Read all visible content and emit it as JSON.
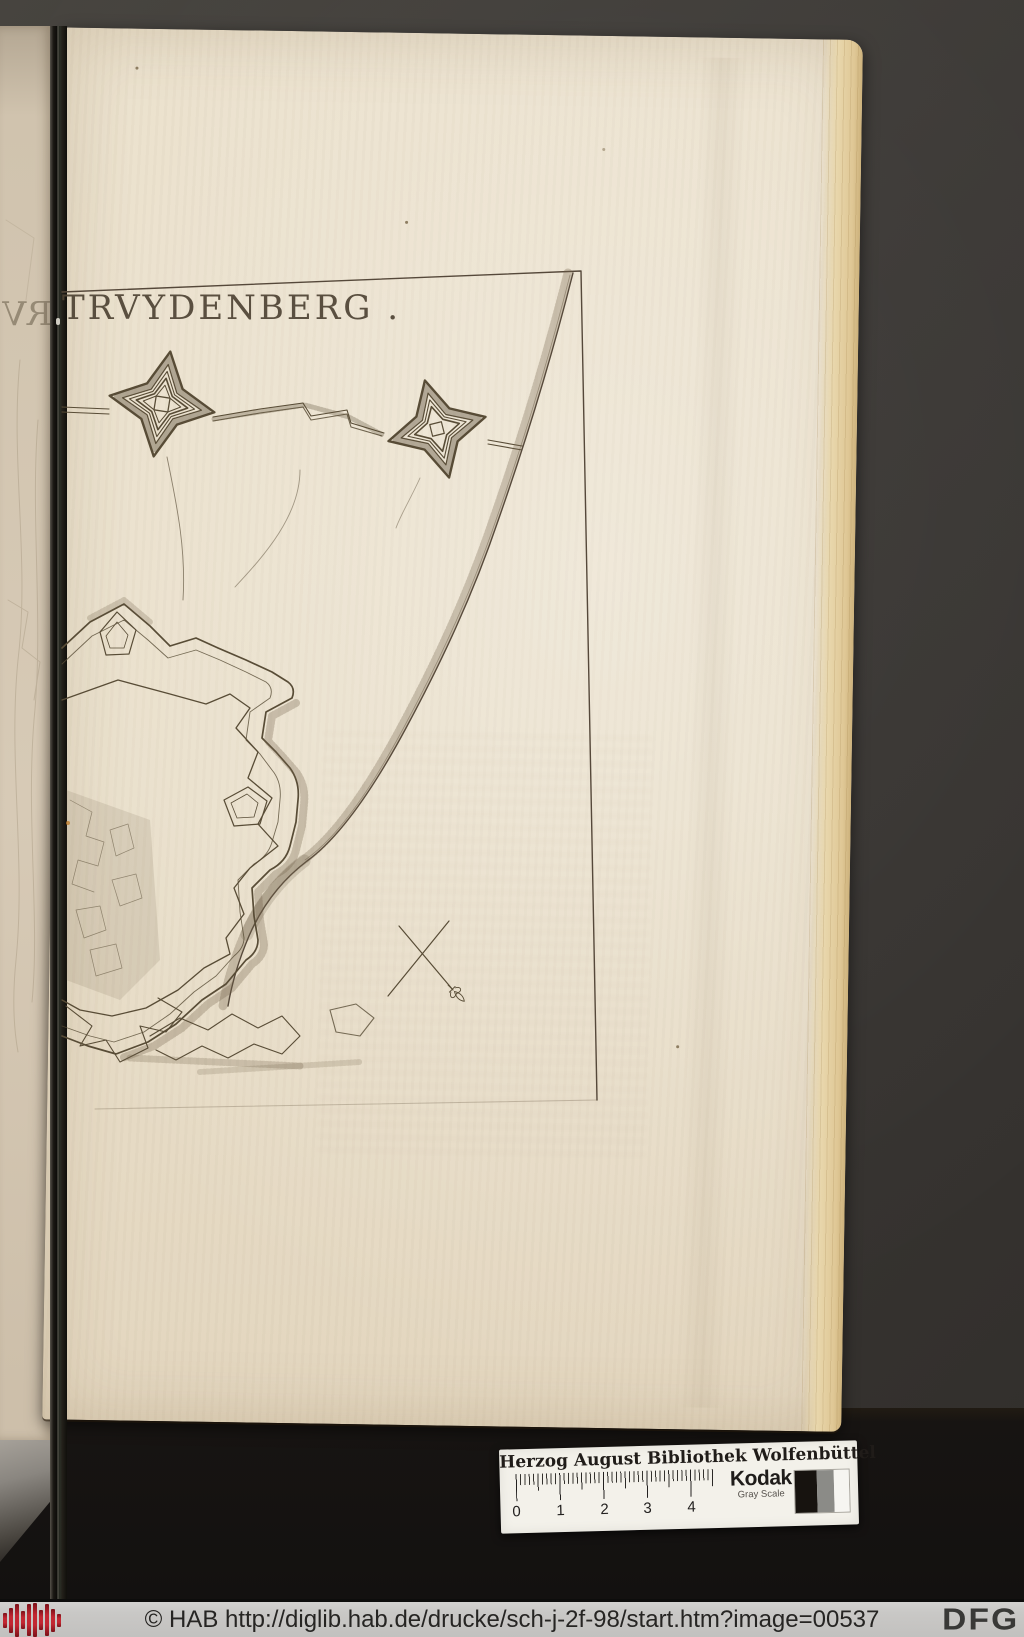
{
  "plate": {
    "title": "TRVYDENBERG .",
    "title_mirrored_fragment": "RV"
  },
  "color_card": {
    "institution": "Herzog August Bibliothek Wolfenbüttel",
    "brand": "Kodak",
    "brand_sub": "Gray Scale",
    "ruler_numbers": [
      "0",
      "1",
      "2",
      "3",
      "4"
    ]
  },
  "footer": {
    "copyright_url": "© HAB http://diglib.hab.de/drucke/sch-j-2f-98/start.htm?image=00537",
    "dfg_logo": "DFG"
  },
  "colors": {
    "ink": "#584c36",
    "paper": "#e9dfca",
    "background": "#3b3835",
    "cradle_black": "#141210",
    "footer_bg": "#c9c8c6",
    "hab_logo_red": "#b02029",
    "card_white": "#f3f1ea"
  }
}
